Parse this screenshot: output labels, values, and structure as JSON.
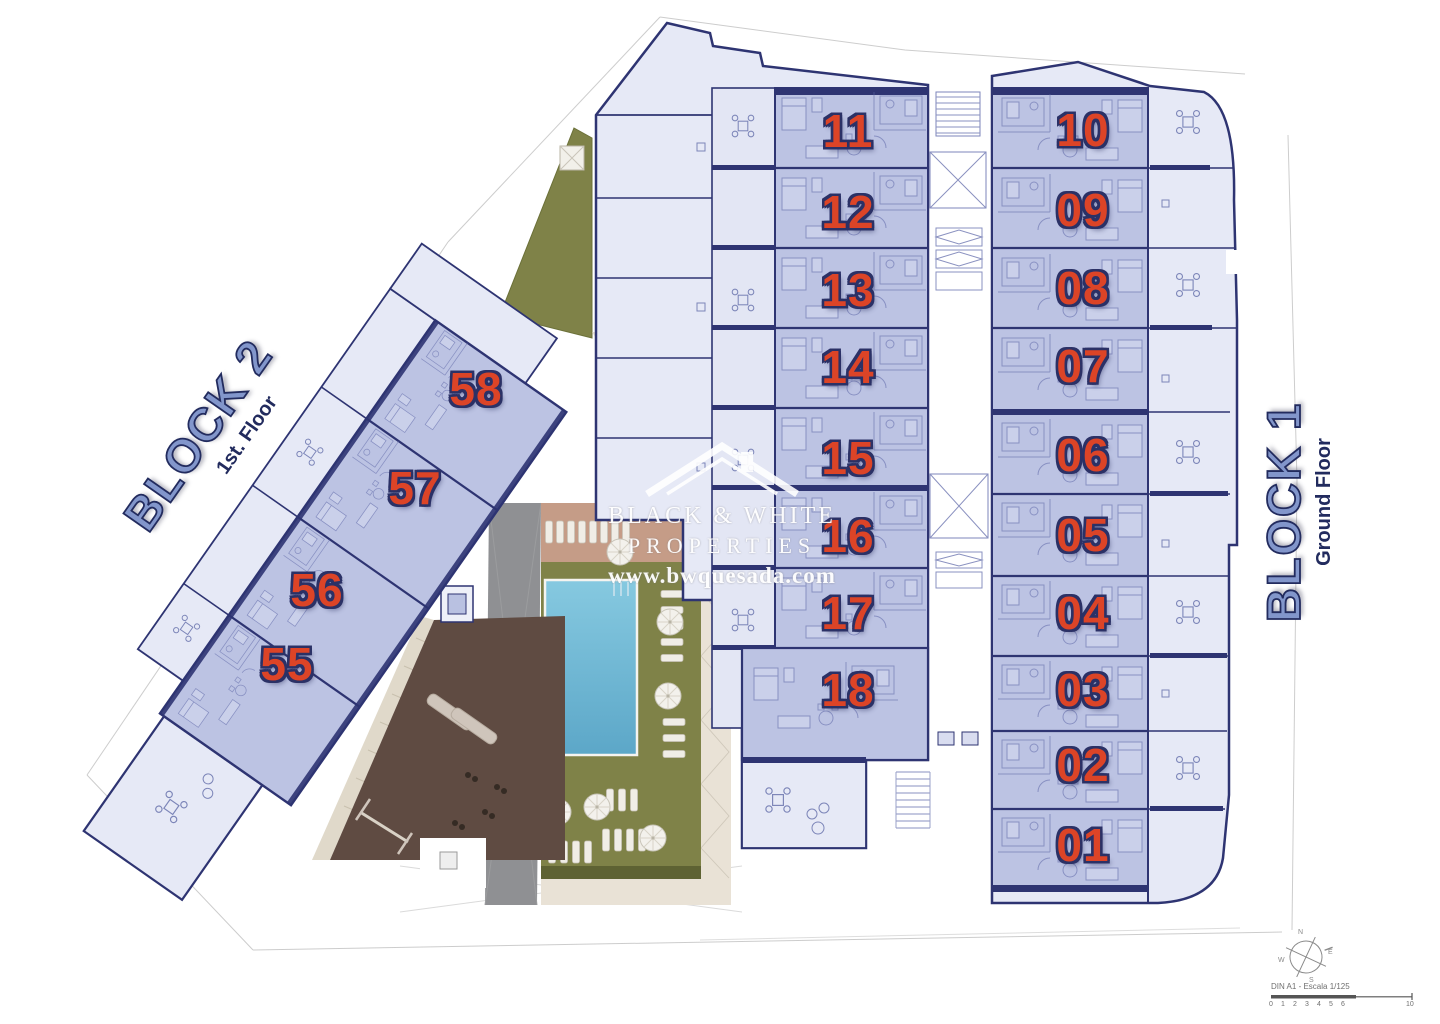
{
  "plan": {
    "watermark": {
      "line1": "BLACK & WHITE",
      "line2": "PROPERTIES",
      "line3": "www.bwquesada.com"
    },
    "block1": {
      "title": "BLOCK 1",
      "subtitle": "Ground Floor",
      "left_units": [
        "11",
        "12",
        "13",
        "14",
        "15",
        "16",
        "17",
        "18"
      ],
      "right_units": [
        "10",
        "09",
        "08",
        "07",
        "06",
        "05",
        "04",
        "03",
        "02",
        "01"
      ]
    },
    "block2": {
      "title": "BLOCK 2",
      "subtitle": "1st. Floor",
      "units": [
        "55",
        "56",
        "57",
        "58"
      ]
    },
    "scale": {
      "label": "DIN A1 - Escala 1/125",
      "ticks": [
        "0",
        "1",
        "2",
        "3",
        "4",
        "5",
        "6",
        "10"
      ]
    },
    "compass": {
      "n": "N",
      "e": "E",
      "s": "S",
      "w": "W"
    },
    "colors": {
      "wall_navy": "#2e3472",
      "unit_fill": "#bcc3e3",
      "terrace_fill": "#e6e9f6",
      "unit_number_red": "#dc4427",
      "block_label_blue": "#8296cb",
      "grass_green": "#7f8248",
      "pool_blue": "#74bcd9",
      "gym_terrace_brown": "#5f4b42",
      "path_gray": "#8f9093"
    }
  }
}
